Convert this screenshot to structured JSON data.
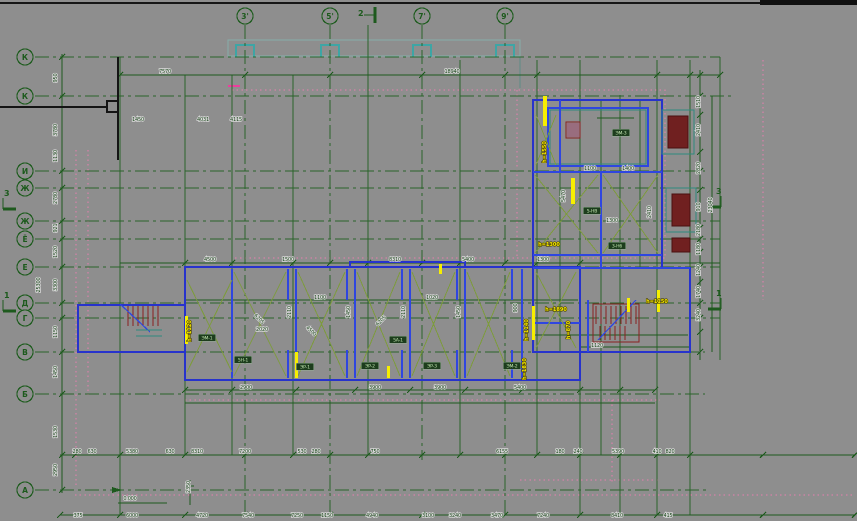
{
  "drawing": {
    "background": "#8e8e8e",
    "accent_colors": {
      "grid_green": "#1e5a1e",
      "wall_blue": "#2733cc",
      "brace_olive": "#7d9b3d",
      "highlight_yellow": "#f4e600",
      "stair_maroon": "#8b2020",
      "dashed_pink": "#e87fb0",
      "slab_teal": "#19b0b0"
    }
  },
  "axes": {
    "top": [
      {
        "label": "3'",
        "x": 245,
        "y2": 515
      },
      {
        "label": "5'",
        "x": 330,
        "y2": 515
      },
      {
        "label": "7'",
        "x": 422,
        "y2": 460
      },
      {
        "label": "9'",
        "x": 505,
        "y2": 515
      }
    ],
    "left": [
      {
        "label": "К",
        "y": 57,
        "x2": 720
      },
      {
        "label": "К",
        "y": 96,
        "x2": 735
      },
      {
        "label": "И",
        "y": 171,
        "x2": 705
      },
      {
        "label": "Ж",
        "y": 188,
        "x2": 705
      },
      {
        "label": "Ж",
        "y": 221,
        "x2": 720
      },
      {
        "label": "Ё",
        "y": 239,
        "x2": 720
      },
      {
        "label": "Е",
        "y": 267,
        "x2": 720
      },
      {
        "label": "Д",
        "y": 303,
        "x2": 720
      },
      {
        "label": "Г",
        "y": 318,
        "x2": 720
      },
      {
        "label": "В",
        "y": 352,
        "x2": 705
      },
      {
        "label": "Б",
        "y": 394,
        "x2": 705
      },
      {
        "label": "А",
        "y": 490,
        "x2": 710
      }
    ]
  },
  "sections": [
    {
      "label": "2",
      "x": 366,
      "y": 13,
      "dir": "top"
    },
    {
      "label": "3",
      "x": 3,
      "y": 198,
      "dir": "left"
    },
    {
      "label": "1",
      "x": 3,
      "y": 300,
      "dir": "left"
    },
    {
      "label": "3",
      "x": 713,
      "y": 196,
      "dir": "right"
    },
    {
      "label": "1",
      "x": 713,
      "y": 298,
      "dir": "right"
    }
  ],
  "dims": [
    {
      "t": "18940",
      "x": 452,
      "y": 73
    },
    {
      "t": "7570",
      "x": 165,
      "y": 73
    },
    {
      "t": "1450",
      "x": 138,
      "y": 121
    },
    {
      "t": "4031",
      "x": 203,
      "y": 121
    },
    {
      "t": "4115",
      "x": 236,
      "y": 121
    },
    {
      "t": "4500",
      "x": 210,
      "y": 261
    },
    {
      "t": "1500",
      "x": 288,
      "y": 261
    },
    {
      "t": "8310",
      "x": 395,
      "y": 261
    },
    {
      "t": "5400",
      "x": 468,
      "y": 261
    },
    {
      "t": "1300",
      "x": 543,
      "y": 261
    },
    {
      "t": "1100",
      "x": 320,
      "y": 299
    },
    {
      "t": "1020",
      "x": 432,
      "y": 299
    },
    {
      "t": "2020",
      "x": 262,
      "y": 331
    },
    {
      "t": "1120",
      "x": 597,
      "y": 347
    },
    {
      "t": "1300",
      "x": 612,
      "y": 222
    },
    {
      "t": "1100",
      "x": 590,
      "y": 170
    },
    {
      "t": "1400",
      "x": 628,
      "y": 170
    },
    {
      "t": "2110",
      "x": 291,
      "y": 312,
      "rot": -90
    },
    {
      "t": "1450",
      "x": 350,
      "y": 312,
      "rot": -90
    },
    {
      "t": "2110",
      "x": 405,
      "y": 312,
      "rot": -90
    },
    {
      "t": "1450",
      "x": 460,
      "y": 312,
      "rot": -90
    },
    {
      "t": "900",
      "x": 517,
      "y": 308,
      "rot": -90
    },
    {
      "t": "5470",
      "x": 565,
      "y": 196,
      "rot": -90
    },
    {
      "t": "2410",
      "x": 651,
      "y": 212,
      "rot": -90
    },
    {
      "t": "6205",
      "x": 258,
      "y": 320,
      "rot": 45
    },
    {
      "t": "6205",
      "x": 382,
      "y": 322,
      "rot": -45
    },
    {
      "t": "4500",
      "x": 310,
      "y": 332,
      "rot": 45
    },
    {
      "t": "2900",
      "x": 246,
      "y": 389
    },
    {
      "t": "3900",
      "x": 375,
      "y": 389
    },
    {
      "t": "3900",
      "x": 440,
      "y": 389
    },
    {
      "t": "5400",
      "x": 520,
      "y": 389
    },
    {
      "t": "280",
      "x": 77,
      "y": 453
    },
    {
      "t": "630",
      "x": 92,
      "y": 453
    },
    {
      "t": "5380",
      "x": 132,
      "y": 453
    },
    {
      "t": "630",
      "x": 170,
      "y": 453
    },
    {
      "t": "8310",
      "x": 197,
      "y": 453
    },
    {
      "t": "7200",
      "x": 245,
      "y": 453
    },
    {
      "t": "530",
      "x": 302,
      "y": 453
    },
    {
      "t": "280",
      "x": 316,
      "y": 453
    },
    {
      "t": "750",
      "x": 375,
      "y": 453
    },
    {
      "t": "6155",
      "x": 502,
      "y": 453
    },
    {
      "t": "180",
      "x": 560,
      "y": 453
    },
    {
      "t": "240",
      "x": 578,
      "y": 453
    },
    {
      "t": "5390",
      "x": 618,
      "y": 453
    },
    {
      "t": "410",
      "x": 657,
      "y": 453
    },
    {
      "t": "820",
      "x": 670,
      "y": 453
    },
    {
      "t": "375",
      "x": 78,
      "y": 517
    },
    {
      "t": "6000",
      "x": 132,
      "y": 517
    },
    {
      "t": "4720",
      "x": 202,
      "y": 517
    },
    {
      "t": "7540",
      "x": 248,
      "y": 517
    },
    {
      "t": "7250",
      "x": 297,
      "y": 517
    },
    {
      "t": "1150",
      "x": 327,
      "y": 517
    },
    {
      "t": "4940",
      "x": 372,
      "y": 517
    },
    {
      "t": "3100",
      "x": 428,
      "y": 517
    },
    {
      "t": "3240",
      "x": 455,
      "y": 517
    },
    {
      "t": "3470",
      "x": 497,
      "y": 517
    },
    {
      "t": "7240",
      "x": 543,
      "y": 517
    },
    {
      "t": "8410",
      "x": 617,
      "y": 517
    },
    {
      "t": "415",
      "x": 668,
      "y": 517
    },
    {
      "t": "950",
      "x": 57,
      "y": 78,
      "rot": -90
    },
    {
      "t": "3780",
      "x": 57,
      "y": 130,
      "rot": -90
    },
    {
      "t": "1130",
      "x": 57,
      "y": 156,
      "rot": -90
    },
    {
      "t": "2780",
      "x": 57,
      "y": 198,
      "rot": -90
    },
    {
      "t": "921",
      "x": 57,
      "y": 228,
      "rot": -90
    },
    {
      "t": "1520",
      "x": 57,
      "y": 252,
      "rot": -90
    },
    {
      "t": "3300",
      "x": 57,
      "y": 285,
      "rot": -90
    },
    {
      "t": "1150",
      "x": 57,
      "y": 332,
      "rot": -90
    },
    {
      "t": "1450",
      "x": 57,
      "y": 372,
      "rot": -90
    },
    {
      "t": "1530",
      "x": 57,
      "y": 432,
      "rot": -90
    },
    {
      "t": "2950",
      "x": 57,
      "y": 470,
      "rot": -90
    },
    {
      "t": "25300",
      "x": 40,
      "y": 285,
      "rot": -90
    },
    {
      "t": "1510",
      "x": 700,
      "y": 102,
      "rot": -90
    },
    {
      "t": "2410",
      "x": 700,
      "y": 130,
      "rot": -90
    },
    {
      "t": "2820",
      "x": 700,
      "y": 168,
      "rot": -90
    },
    {
      "t": "910",
      "x": 700,
      "y": 207,
      "rot": -90
    },
    {
      "t": "2180",
      "x": 700,
      "y": 230,
      "rot": -90
    },
    {
      "t": "1180",
      "x": 700,
      "y": 249,
      "rot": -90
    },
    {
      "t": "1240",
      "x": 700,
      "y": 270,
      "rot": -90
    },
    {
      "t": "1740",
      "x": 700,
      "y": 292,
      "rot": -90
    },
    {
      "t": "3240",
      "x": 700,
      "y": 315,
      "rot": -90
    },
    {
      "t": "23040",
      "x": 712,
      "y": 205,
      "rot": -90
    },
    {
      "t": "0.000",
      "x": 130,
      "y": 500
    },
    {
      "t": "2350",
      "x": 190,
      "y": 487,
      "rot": -90
    }
  ],
  "yellow_labels": [
    {
      "t": "h=1550",
      "x": 546,
      "y": 152,
      "rot": -90
    },
    {
      "t": "h=1300",
      "x": 549,
      "y": 246
    },
    {
      "t": "h=1890",
      "x": 556,
      "y": 311
    },
    {
      "t": "h=1140",
      "x": 528,
      "y": 330,
      "rot": -90
    },
    {
      "t": "h=870",
      "x": 570,
      "y": 330,
      "rot": -90
    },
    {
      "t": "h=1150",
      "x": 657,
      "y": 303
    },
    {
      "t": "h=1120",
      "x": 191,
      "y": 331,
      "rot": -90
    },
    {
      "t": "h=1830",
      "x": 526,
      "y": 369,
      "rot": -90
    }
  ],
  "room_labels": [
    {
      "t": "ЭМ-1",
      "x": 207,
      "y": 339
    },
    {
      "t": "5Н-1",
      "x": 243,
      "y": 361
    },
    {
      "t": "ЭР-1",
      "x": 305,
      "y": 368
    },
    {
      "t": "5А-1",
      "x": 398,
      "y": 341
    },
    {
      "t": "ЭР-2",
      "x": 370,
      "y": 367
    },
    {
      "t": "ЭР-3",
      "x": 432,
      "y": 367
    },
    {
      "t": "ЭМ-2",
      "x": 512,
      "y": 367
    },
    {
      "t": "ЭМ-3",
      "x": 621,
      "y": 134
    },
    {
      "t": "5-НВ",
      "x": 592,
      "y": 212
    },
    {
      "t": "3-Н6",
      "x": 617,
      "y": 247
    }
  ]
}
